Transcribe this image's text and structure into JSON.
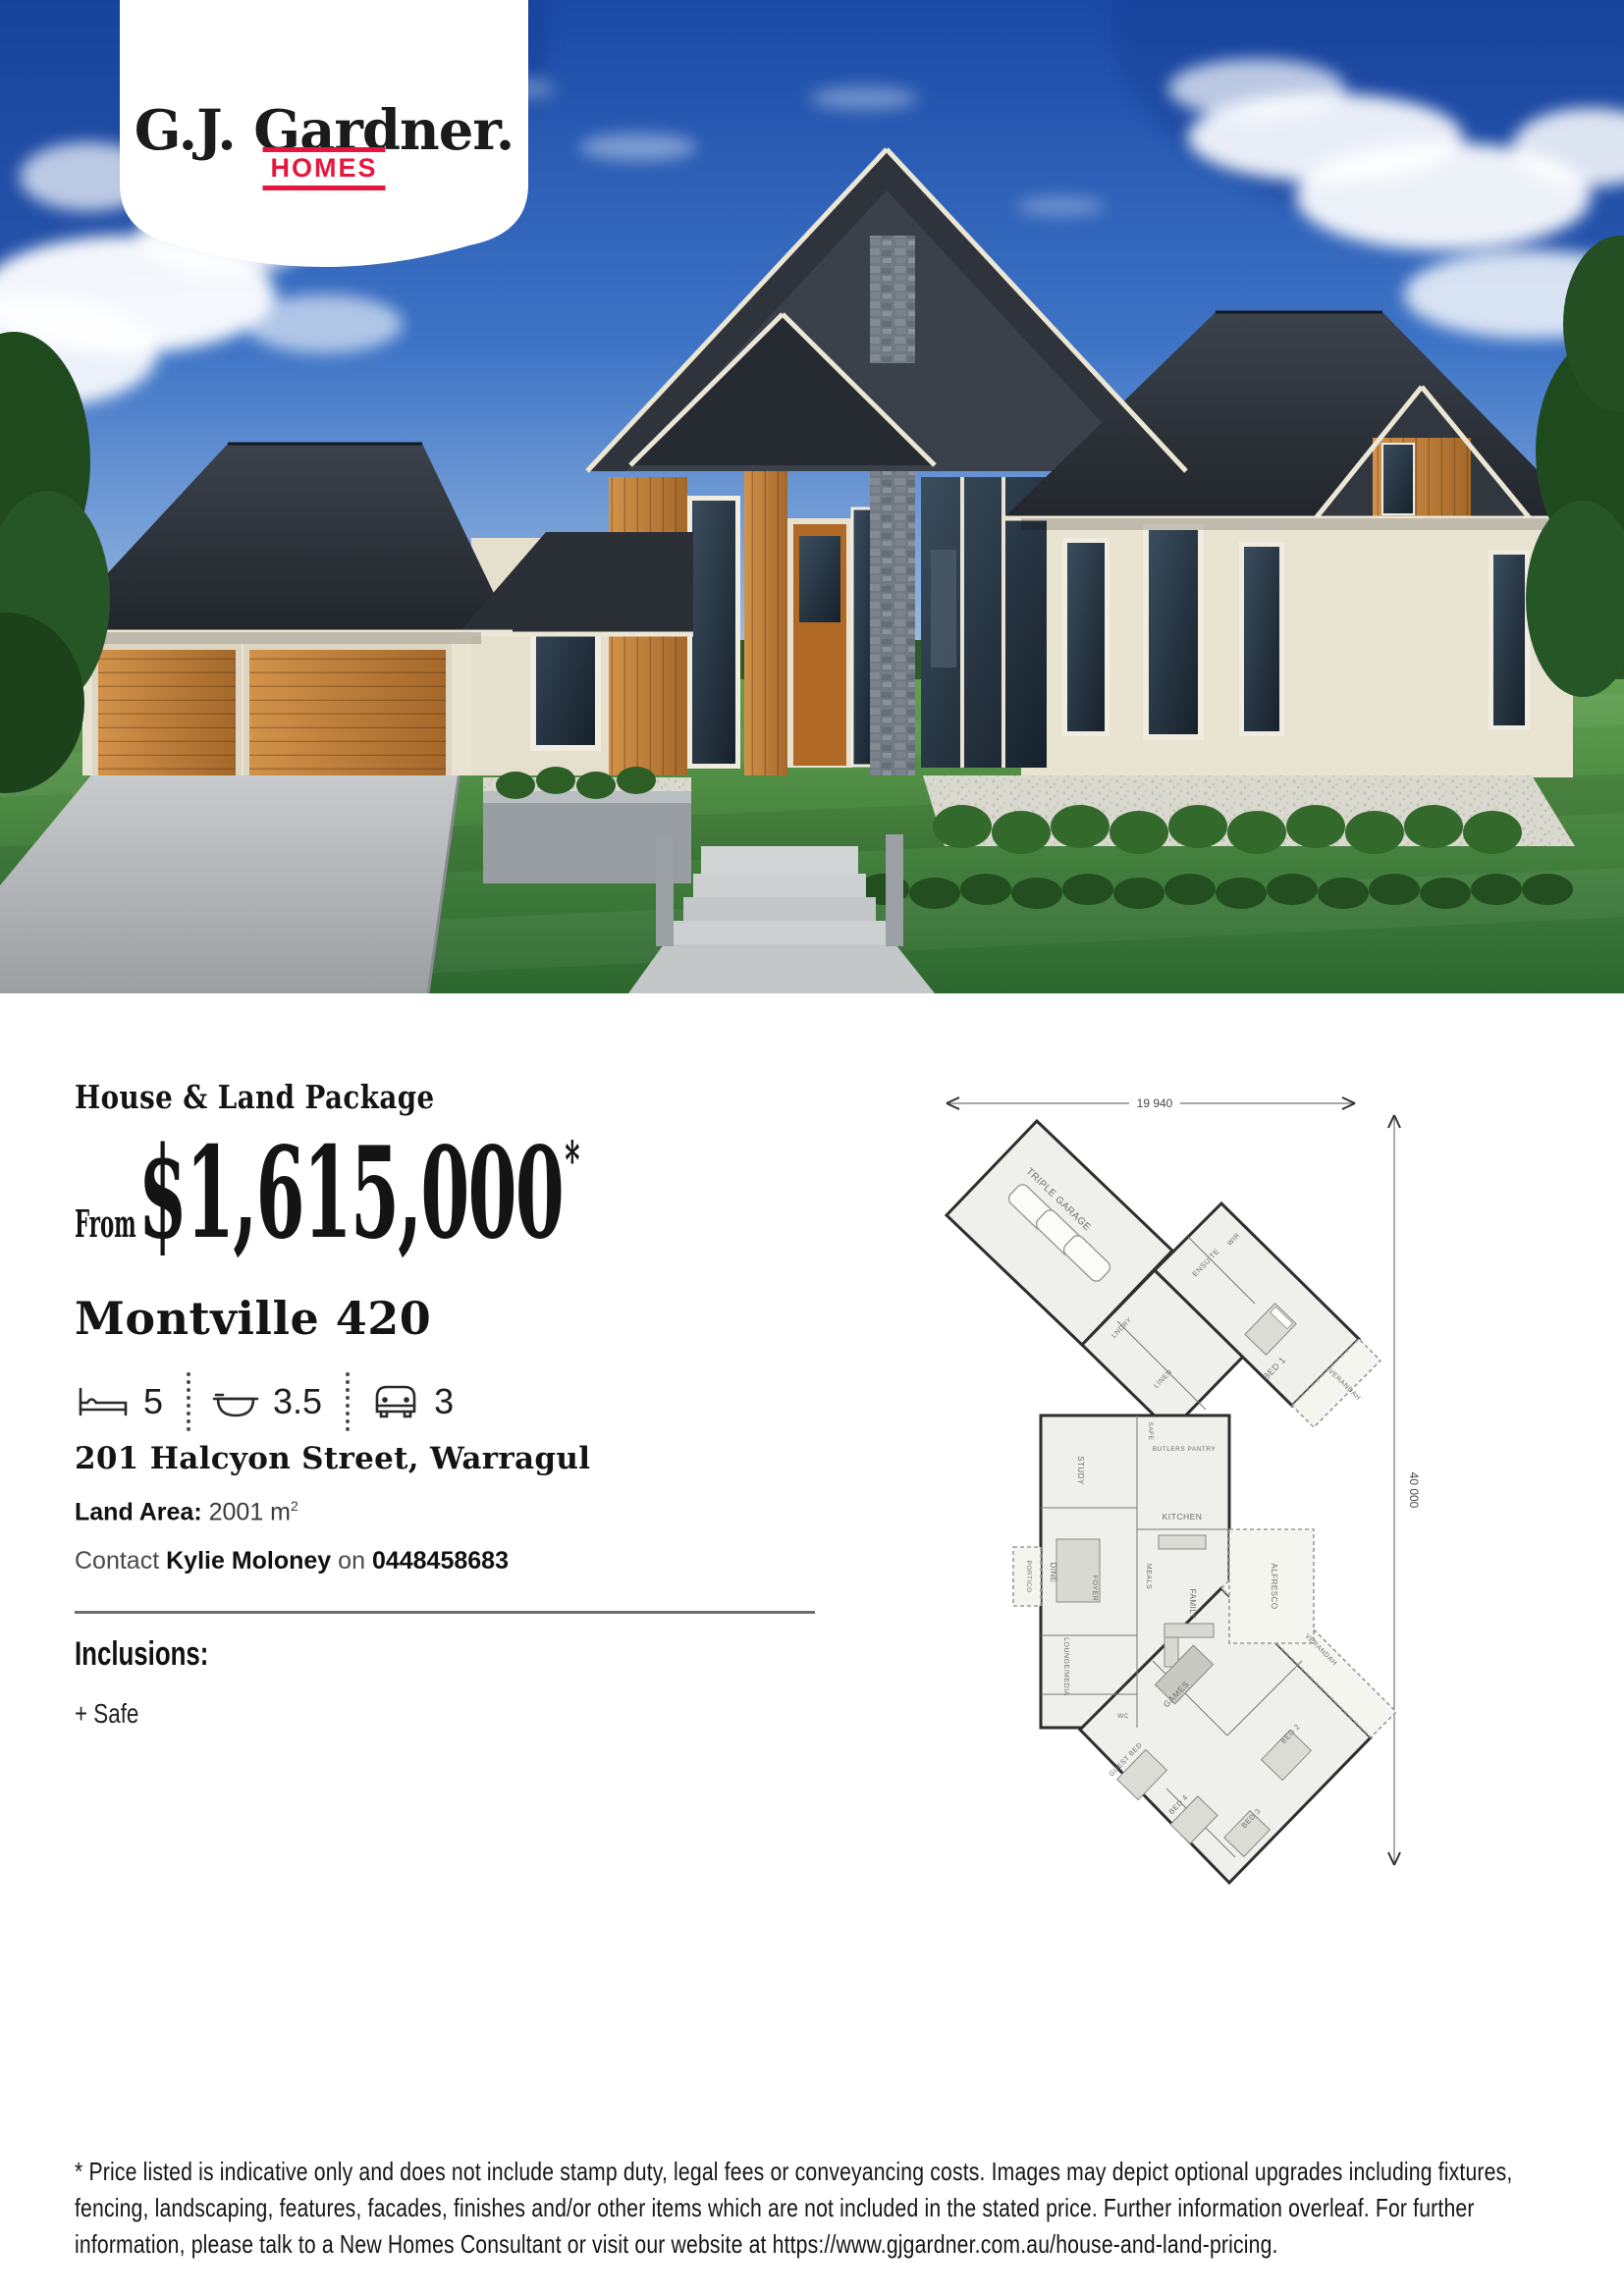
{
  "brand": {
    "name": "G.J. Gardner.",
    "tagline": "HOMES"
  },
  "listing": {
    "heading": "House & Land Package",
    "from_label": "From",
    "price": "$1,615,000",
    "price_note_symbol": "*",
    "plan_name": "Montville 420",
    "specs": {
      "beds": "5",
      "baths": "3.5",
      "cars": "3"
    },
    "address": "201 Halcyon Street, Warragul",
    "land_area_label": "Land Area:",
    "land_area_value": "2001 m",
    "land_area_exponent": "2",
    "contact_prefix": "Contact",
    "contact_name": "Kylie Moloney",
    "contact_connector": "on",
    "contact_phone": "0448458683",
    "inclusions_heading": "Inclusions:",
    "inclusions": [
      "+ Safe"
    ]
  },
  "floorplan": {
    "dim_width": "19 940",
    "dim_height": "40 000",
    "rooms": [
      "TRIPLE GARAGE",
      "LNDRY",
      "LINEN",
      "ENSUITE",
      "WIR",
      "BED 1",
      "STUDY",
      "SAFE",
      "BUTLERS PANTRY",
      "KITCHEN",
      "DINE",
      "MEALS",
      "FOYER",
      "PORTICO",
      "LOUNGE/MEDIA",
      "FAMILY",
      "ALFRESCO",
      "WC",
      "GAMES",
      "GUEST BED",
      "BED 4",
      "BED 2",
      "BED 3",
      "VERANDAH"
    ]
  },
  "disclaimer": "* Price listed is indicative only and does not include stamp duty, legal fees or conveyancing costs. Images may depict optional upgrades including fixtures, fencing, landscaping, features, facades, finishes and/or other items which are not included in the stated price. Further information overleaf. For further information, please talk to a New Homes Consultant or visit our website at https://www.gjgardner.com.au/house-and-land-pricing.",
  "colors": {
    "brand_red": "#e5173f",
    "heading_text": "#141414",
    "body_text": "#262626"
  }
}
